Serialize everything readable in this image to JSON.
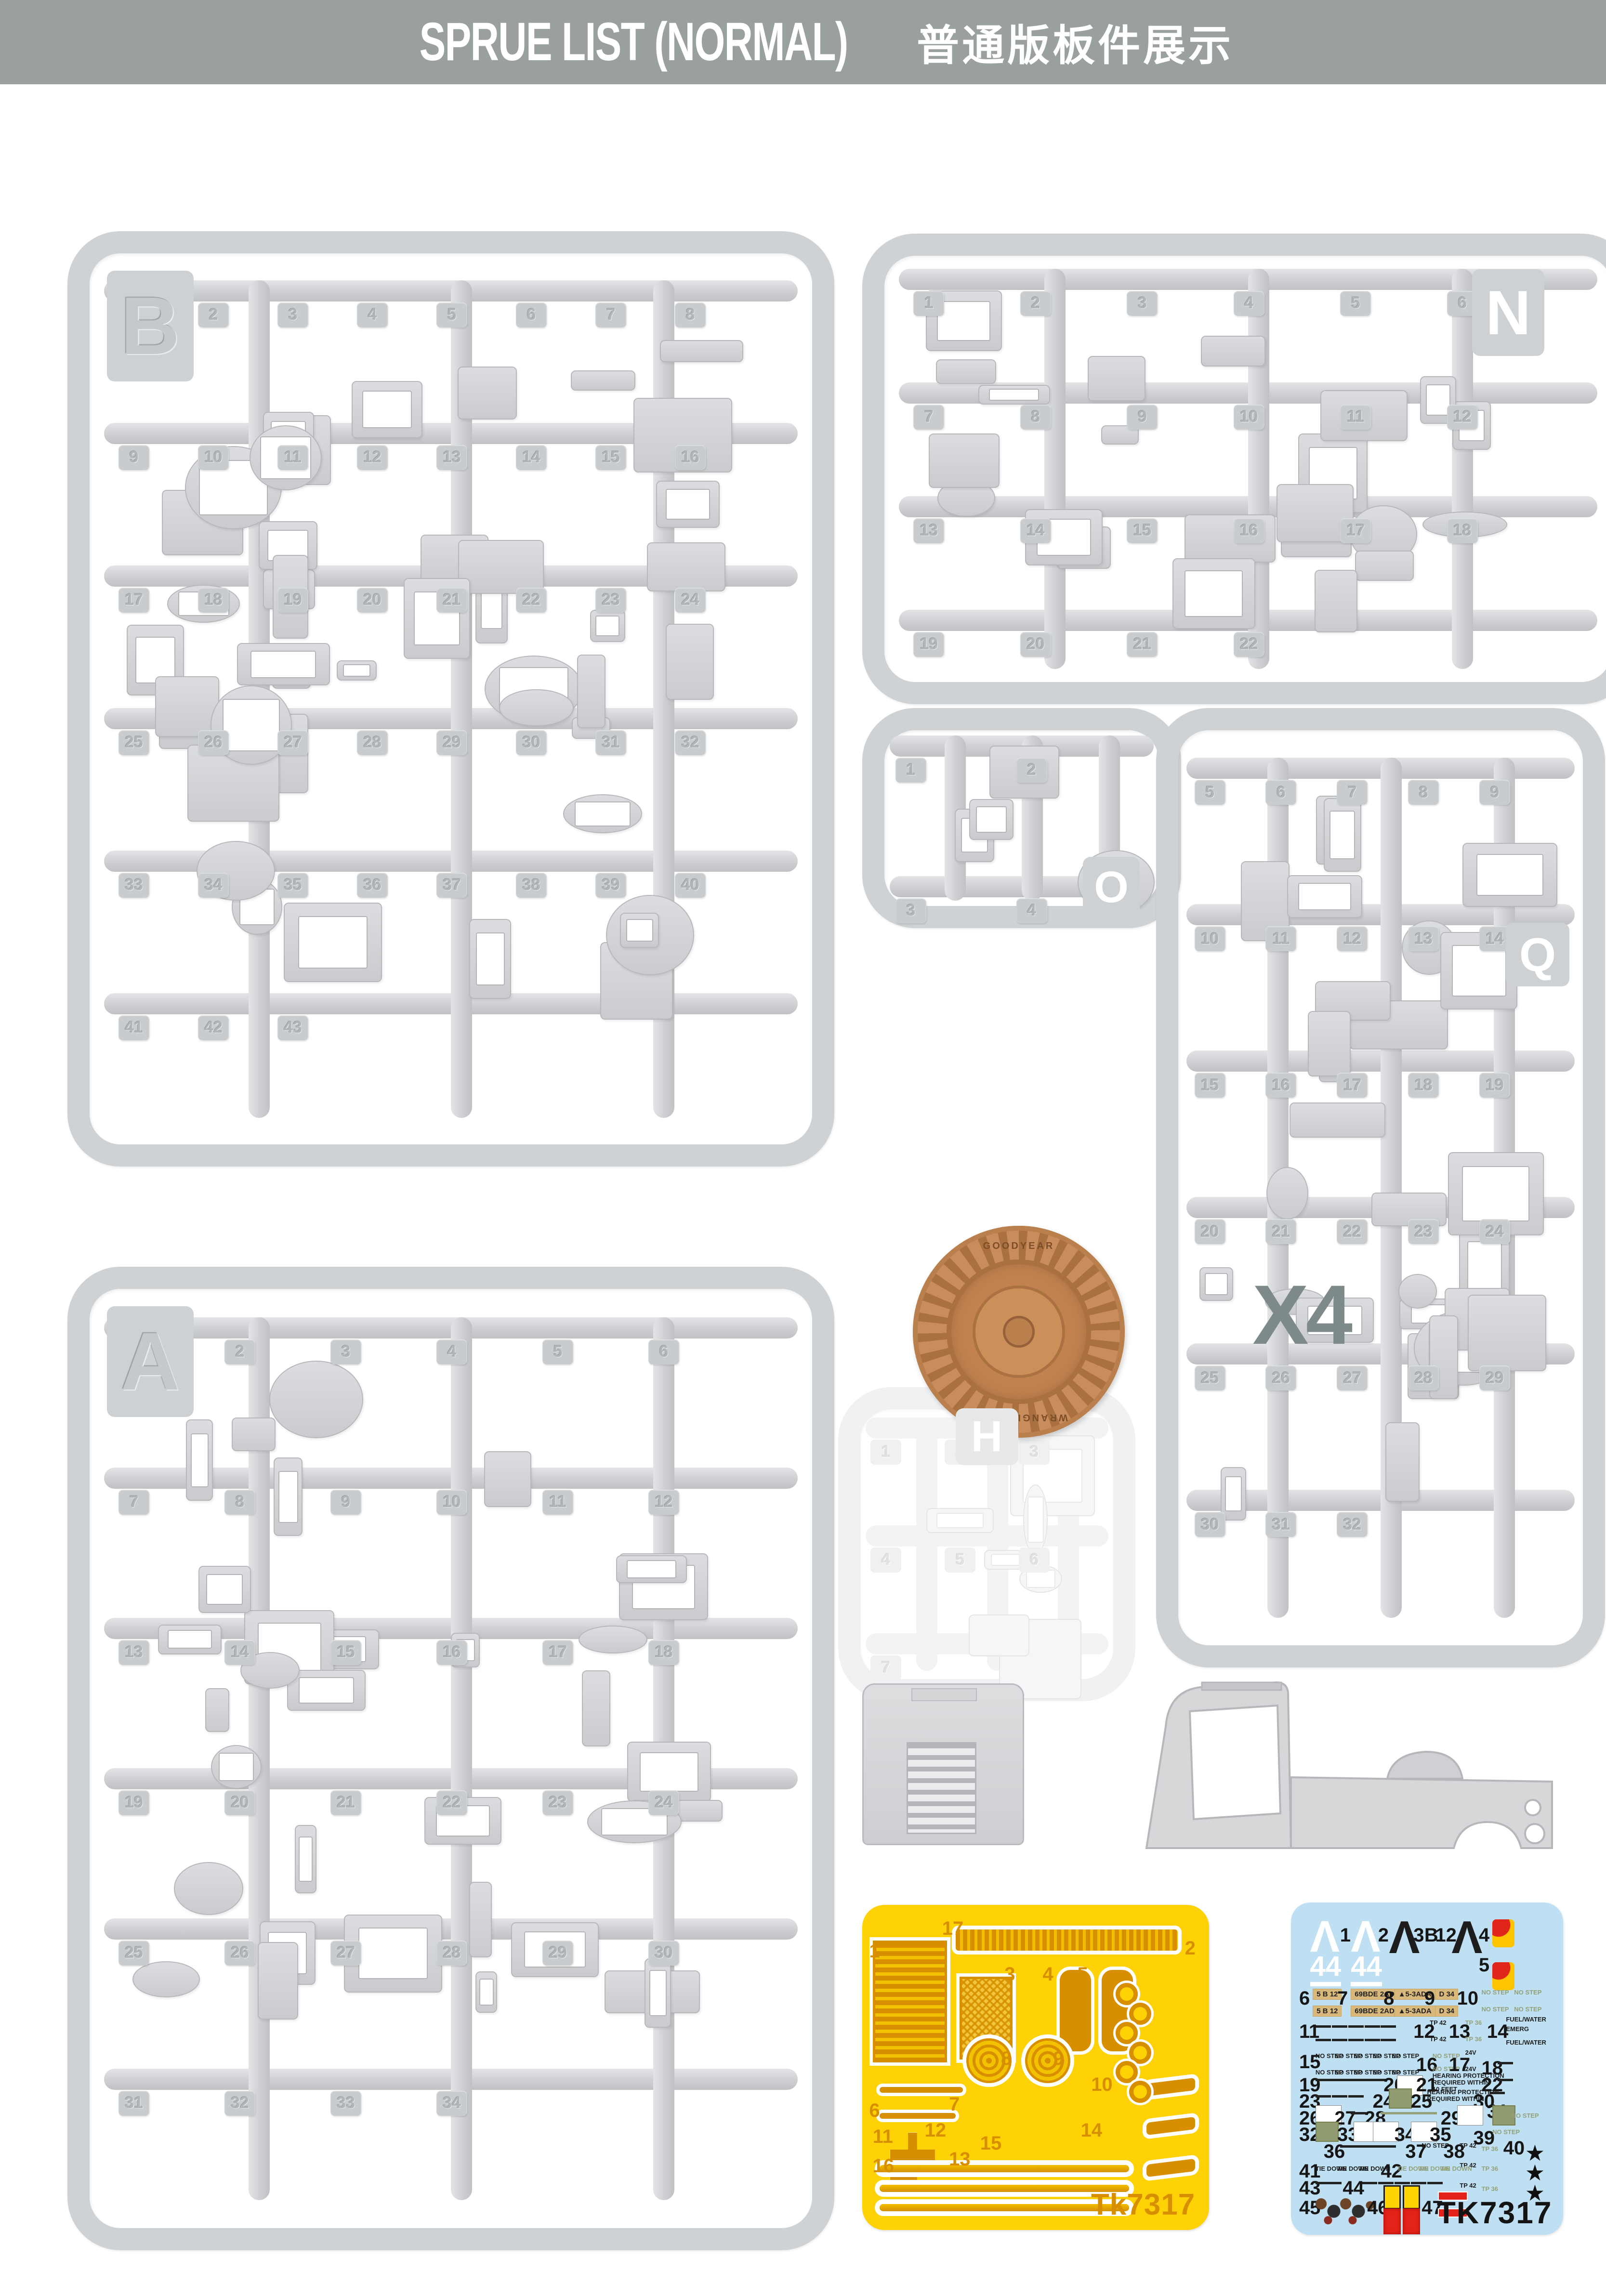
{
  "header": {
    "title_en": "SPRUE LIST (NORMAL)",
    "title_zh": "普通版板件展示"
  },
  "colors": {
    "header_bg": "#9aa0a0",
    "header_text": "#ffffff",
    "plastic": "#d2d4d6",
    "clear_plastic": "#f2f3f4",
    "tire": "#c98c5c",
    "quantity_text": "#7e898a",
    "pe_bg": "#ffd205",
    "pe_part": "#d78f00",
    "decal_bg": "#bfe0f2"
  },
  "sprues": {
    "b": {
      "letter": "B",
      "parts": [
        1,
        2,
        3,
        4,
        5,
        6,
        7,
        8,
        9,
        10,
        11,
        12,
        13,
        14,
        15,
        16,
        17,
        18,
        19,
        20,
        21,
        22,
        23,
        24,
        25,
        26,
        27,
        28,
        29,
        30,
        31,
        32,
        33,
        34,
        35,
        36,
        37,
        38,
        39,
        40,
        41,
        42,
        43
      ]
    },
    "n": {
      "letter": "N",
      "parts": [
        1,
        2,
        3,
        4,
        5,
        6,
        7,
        8,
        9,
        10,
        11,
        12,
        13,
        14,
        15,
        16,
        17,
        18,
        19,
        20,
        21,
        22
      ]
    },
    "o": {
      "letter": "O",
      "parts": [
        1,
        2,
        3,
        4
      ]
    },
    "q": {
      "letter": "Q",
      "parts": [
        5,
        6,
        7,
        8,
        9,
        10,
        11,
        12,
        13,
        14,
        15,
        16,
        17,
        18,
        19,
        20,
        21,
        22,
        23,
        24,
        25,
        26,
        27,
        28,
        29,
        30,
        31,
        32
      ]
    },
    "a": {
      "letter": "A",
      "parts": [
        1,
        2,
        3,
        4,
        5,
        6,
        7,
        8,
        9,
        10,
        11,
        12,
        13,
        14,
        15,
        16,
        17,
        18,
        19,
        20,
        21,
        22,
        23,
        24,
        25,
        26,
        27,
        28,
        29,
        30,
        31,
        32,
        33,
        34
      ]
    },
    "h": {
      "letter": "H",
      "parts": [
        1,
        2,
        3,
        4,
        5,
        6,
        7
      ]
    }
  },
  "wheel": {
    "quantity_label": "X4",
    "tire_brand": "GOODYEAR",
    "tire_model": "WRANGLER R/T"
  },
  "pe_fret": {
    "code": "Tk7317",
    "items": [
      {
        "k": "pnum",
        "x": 2,
        "y": 11,
        "t": "1"
      },
      {
        "k": "pnum",
        "x": 23,
        "y": 4,
        "t": "17"
      },
      {
        "k": "pnum",
        "x": 93,
        "y": 10,
        "t": "2"
      },
      {
        "k": "pnum",
        "x": 41,
        "y": 18,
        "t": "3"
      },
      {
        "k": "pnum",
        "x": 52,
        "y": 18,
        "t": "4"
      },
      {
        "k": "pnum",
        "x": 62,
        "y": 18,
        "t": "5"
      },
      {
        "k": "pnum",
        "x": 2,
        "y": 60,
        "t": "6"
      },
      {
        "k": "pnum",
        "x": 25,
        "y": 58,
        "t": "7"
      },
      {
        "k": "pnum",
        "x": 40,
        "y": 44,
        "t": "8"
      },
      {
        "k": "pnum",
        "x": 55,
        "y": 44,
        "t": "9"
      },
      {
        "k": "pnum",
        "x": 66,
        "y": 52,
        "t": "10"
      },
      {
        "k": "pnum",
        "x": 3,
        "y": 68,
        "t": "11"
      },
      {
        "k": "pnum",
        "x": 18,
        "y": 66,
        "t": "12"
      },
      {
        "k": "pnum",
        "x": 25,
        "y": 75,
        "t": "13"
      },
      {
        "k": "pnum",
        "x": 63,
        "y": 66,
        "t": "14"
      },
      {
        "k": "pnum",
        "x": 34,
        "y": 70,
        "t": "15"
      },
      {
        "k": "pnum",
        "x": 3,
        "y": 77,
        "t": "16"
      },
      {
        "k": "pdot",
        "x": 73,
        "y": 24
      },
      {
        "k": "pdot",
        "x": 77,
        "y": 30
      },
      {
        "k": "pdot",
        "x": 73,
        "y": 36
      },
      {
        "k": "pdot",
        "x": 77,
        "y": 42
      },
      {
        "k": "pdot",
        "x": 73,
        "y": 48
      },
      {
        "k": "pdot",
        "x": 77,
        "y": 54
      }
    ]
  },
  "decal_sheet": {
    "code": "TK7317",
    "items": [
      {
        "k": "chw",
        "x": 7,
        "y": 5,
        "t": "Λ"
      },
      {
        "k": "n",
        "x": 18,
        "y": 7,
        "t": "1"
      },
      {
        "k": "chw",
        "x": 22,
        "y": 5,
        "t": "Λ"
      },
      {
        "k": "n44",
        "x": 7,
        "y": 15,
        "t": "44"
      },
      {
        "k": "n44",
        "x": 22,
        "y": 15,
        "t": "44"
      },
      {
        "k": "n",
        "x": 32,
        "y": 7,
        "t": "2"
      },
      {
        "k": "chb",
        "x": 36,
        "y": 5,
        "t": "Λ"
      },
      {
        "k": "n",
        "x": 45,
        "y": 7,
        "t": "3"
      },
      {
        "k": "n",
        "x": 49,
        "y": 7,
        "t": "B"
      },
      {
        "k": "n",
        "x": 53,
        "y": 7,
        "t": "12"
      },
      {
        "k": "chb",
        "x": 59,
        "y": 5,
        "t": "Λ"
      },
      {
        "k": "n",
        "x": 69,
        "y": 7,
        "t": "4"
      },
      {
        "k": "flag",
        "x": 74,
        "y": 5
      },
      {
        "k": "n",
        "x": 69,
        "y": 16,
        "t": "5"
      },
      {
        "k": "flag",
        "x": 74,
        "y": 18
      },
      {
        "k": "n",
        "x": 3,
        "y": 26,
        "t": "6"
      },
      {
        "k": "tan",
        "x": 8,
        "y": 26,
        "t": "5 B 12"
      },
      {
        "k": "n",
        "x": 17,
        "y": 26,
        "t": "7"
      },
      {
        "k": "tan",
        "x": 22,
        "y": 26,
        "t": "69BDE 2ADA"
      },
      {
        "k": "n",
        "x": 34,
        "y": 26,
        "t": "8"
      },
      {
        "k": "tan",
        "x": 38,
        "y": 26,
        "t": "▲5-3ADA"
      },
      {
        "k": "n",
        "x": 49,
        "y": 26,
        "t": "9"
      },
      {
        "k": "tan",
        "x": 53,
        "y": 26,
        "t": "D 34"
      },
      {
        "k": "n",
        "x": 61,
        "y": 26,
        "t": "10"
      },
      {
        "k": "smg",
        "x": 70,
        "y": 26,
        "t": "NO STEP"
      },
      {
        "k": "smg",
        "x": 82,
        "y": 26,
        "t": "NO STEP"
      },
      {
        "k": "tan",
        "x": 8,
        "y": 31,
        "t": "5 B 12"
      },
      {
        "k": "tan",
        "x": 22,
        "y": 31,
        "t": "69BDE 2ADA"
      },
      {
        "k": "tan",
        "x": 38,
        "y": 31,
        "t": "▲5-3ADA"
      },
      {
        "k": "tan",
        "x": 53,
        "y": 31,
        "t": "D 34"
      },
      {
        "k": "smg",
        "x": 70,
        "y": 31,
        "t": "NO STEP"
      },
      {
        "k": "smg",
        "x": 82,
        "y": 31,
        "t": "NO STEP"
      },
      {
        "k": "n",
        "x": 3,
        "y": 36,
        "t": "11"
      },
      {
        "k": "bar",
        "x": 9,
        "y": 37
      },
      {
        "k": "bar",
        "x": 15,
        "y": 37
      },
      {
        "k": "bar",
        "x": 21,
        "y": 37
      },
      {
        "k": "bar",
        "x": 27,
        "y": 37
      },
      {
        "k": "bar",
        "x": 33,
        "y": 37
      },
      {
        "k": "bar",
        "x": 9,
        "y": 41
      },
      {
        "k": "bar",
        "x": 15,
        "y": 41
      },
      {
        "k": "bar",
        "x": 21,
        "y": 41
      },
      {
        "k": "bar",
        "x": 27,
        "y": 41
      },
      {
        "k": "bar",
        "x": 33,
        "y": 41
      },
      {
        "k": "n",
        "x": 45,
        "y": 36,
        "t": "12"
      },
      {
        "k": "sm",
        "x": 51,
        "y": 35,
        "t": "TP 42"
      },
      {
        "k": "sm",
        "x": 51,
        "y": 40,
        "t": "TP 42"
      },
      {
        "k": "n",
        "x": 58,
        "y": 36,
        "t": "13"
      },
      {
        "k": "smg",
        "x": 64,
        "y": 35,
        "t": "TP 36"
      },
      {
        "k": "smg",
        "x": 64,
        "y": 40,
        "t": "TP 36"
      },
      {
        "k": "n",
        "x": 72,
        "y": 36,
        "t": "14"
      },
      {
        "k": "sm",
        "x": 79,
        "y": 34,
        "t": "FUEL/WATER"
      },
      {
        "k": "sm",
        "x": 79,
        "y": 37,
        "t": "EMERG"
      },
      {
        "k": "sm",
        "x": 79,
        "y": 41,
        "t": "FUEL/WATER"
      },
      {
        "k": "n",
        "x": 3,
        "y": 45,
        "t": "15"
      },
      {
        "k": "sm",
        "x": 9,
        "y": 45,
        "t": "NO STEP"
      },
      {
        "k": "sm",
        "x": 16,
        "y": 45,
        "t": "NO STEP"
      },
      {
        "k": "sm",
        "x": 23,
        "y": 45,
        "t": "NO STEP"
      },
      {
        "k": "sm",
        "x": 30,
        "y": 45,
        "t": "NO STEP"
      },
      {
        "k": "sm",
        "x": 37,
        "y": 45,
        "t": "NO STEP"
      },
      {
        "k": "sm",
        "x": 9,
        "y": 50,
        "t": "NO STEP"
      },
      {
        "k": "sm",
        "x": 16,
        "y": 50,
        "t": "NO STEP"
      },
      {
        "k": "sm",
        "x": 23,
        "y": 50,
        "t": "NO STEP"
      },
      {
        "k": "sm",
        "x": 30,
        "y": 50,
        "t": "NO STEP"
      },
      {
        "k": "sm",
        "x": 37,
        "y": 50,
        "t": "NO STEP"
      },
      {
        "k": "n",
        "x": 46,
        "y": 46,
        "t": "16"
      },
      {
        "k": "smg",
        "x": 52,
        "y": 45,
        "t": "NO STEP"
      },
      {
        "k": "smg",
        "x": 52,
        "y": 49,
        "t": "NO STEP"
      },
      {
        "k": "n",
        "x": 58,
        "y": 46,
        "t": "17"
      },
      {
        "k": "sm",
        "x": 64,
        "y": 44,
        "t": "24V"
      },
      {
        "k": "sm",
        "x": 64,
        "y": 49,
        "t": "24V"
      },
      {
        "k": "n",
        "x": 70,
        "y": 47,
        "t": "18"
      },
      {
        "k": "bar",
        "x": 76,
        "y": 48
      },
      {
        "k": "n",
        "x": 3,
        "y": 52,
        "t": "19"
      },
      {
        "k": "bar",
        "x": 9,
        "y": 53
      },
      {
        "k": "bar",
        "x": 14,
        "y": 53
      },
      {
        "k": "bar",
        "x": 19,
        "y": 53
      },
      {
        "k": "bar",
        "x": 24,
        "y": 53
      },
      {
        "k": "bar",
        "x": 29,
        "y": 53
      },
      {
        "k": "n",
        "x": 34,
        "y": 52,
        "t": "20"
      },
      {
        "k": "wbox",
        "x": 39,
        "y": 52
      },
      {
        "k": "n",
        "x": 46,
        "y": 52,
        "t": "21"
      },
      {
        "k": "sm",
        "x": 52,
        "y": 51,
        "t": "HEARING PROTECTION"
      },
      {
        "k": "sm",
        "x": 52,
        "y": 53,
        "t": "REQUIRED WITHIN"
      },
      {
        "k": "sm",
        "x": 52,
        "y": 55,
        "t": "10 FEET"
      },
      {
        "k": "n",
        "x": 70,
        "y": 52,
        "t": "22"
      },
      {
        "k": "bar",
        "x": 76,
        "y": 53
      },
      {
        "k": "n",
        "x": 3,
        "y": 57,
        "t": "23"
      },
      {
        "k": "bar",
        "x": 9,
        "y": 58
      },
      {
        "k": "bar",
        "x": 15,
        "y": 58
      },
      {
        "k": "bar",
        "x": 21,
        "y": 58
      },
      {
        "k": "n",
        "x": 30,
        "y": 57,
        "t": "24"
      },
      {
        "k": "gbox",
        "x": 36,
        "y": 56
      },
      {
        "k": "n",
        "x": 44,
        "y": 57,
        "t": "25"
      },
      {
        "k": "sm",
        "x": 50,
        "y": 56,
        "t": "HEARING PROTECTION"
      },
      {
        "k": "sm",
        "x": 50,
        "y": 58,
        "t": "REQUIRED WITHIN"
      },
      {
        "k": "n",
        "x": 67,
        "y": 57,
        "t": "30"
      },
      {
        "k": "bar",
        "x": 73,
        "y": 57
      },
      {
        "k": "n",
        "x": 72,
        "y": 60,
        "t": "31"
      },
      {
        "k": "n",
        "x": 3,
        "y": 62,
        "t": "26"
      },
      {
        "k": "wbox",
        "x": 9,
        "y": 61
      },
      {
        "k": "n",
        "x": 16,
        "y": 62,
        "t": "27"
      },
      {
        "k": "bar",
        "x": 22,
        "y": 63
      },
      {
        "k": "n",
        "x": 27,
        "y": 62,
        "t": "28"
      },
      {
        "k": "obar",
        "x": 33,
        "y": 63
      },
      {
        "k": "obar",
        "x": 38,
        "y": 63
      },
      {
        "k": "obar",
        "x": 43,
        "y": 63
      },
      {
        "k": "obar",
        "x": 48,
        "y": 63
      },
      {
        "k": "n",
        "x": 55,
        "y": 62,
        "t": "29"
      },
      {
        "k": "wbox",
        "x": 61,
        "y": 61
      },
      {
        "k": "gbox",
        "x": 74,
        "y": 61
      },
      {
        "k": "smg",
        "x": 81,
        "y": 63,
        "t": "NO STEP"
      },
      {
        "k": "n",
        "x": 3,
        "y": 67,
        "t": "32"
      },
      {
        "k": "gbox",
        "x": 9,
        "y": 66
      },
      {
        "k": "n",
        "x": 17,
        "y": 67,
        "t": "33"
      },
      {
        "k": "wbox",
        "x": 23,
        "y": 66
      },
      {
        "k": "wbox",
        "x": 30,
        "y": 66
      },
      {
        "k": "n",
        "x": 38,
        "y": 67,
        "t": "34"
      },
      {
        "k": "wbox",
        "x": 44,
        "y": 66
      },
      {
        "k": "n",
        "x": 51,
        "y": 67,
        "t": "35"
      },
      {
        "k": "n",
        "x": 67,
        "y": 68,
        "t": "39"
      },
      {
        "k": "smg",
        "x": 74,
        "y": 68,
        "t": "NO STEP"
      },
      {
        "k": "n",
        "x": 12,
        "y": 72,
        "t": "36"
      },
      {
        "k": "bar",
        "x": 18,
        "y": 73
      },
      {
        "k": "bar",
        "x": 23,
        "y": 73
      },
      {
        "k": "bar",
        "x": 28,
        "y": 73
      },
      {
        "k": "bar",
        "x": 33,
        "y": 73
      },
      {
        "k": "n",
        "x": 42,
        "y": 72,
        "t": "37"
      },
      {
        "k": "sm",
        "x": 48,
        "y": 72,
        "t": "NO STEP"
      },
      {
        "k": "n",
        "x": 56,
        "y": 72,
        "t": "38"
      },
      {
        "k": "sm",
        "x": 62,
        "y": 72,
        "t": "TP 42"
      },
      {
        "k": "smg",
        "x": 70,
        "y": 73,
        "t": "TP 36"
      },
      {
        "k": "n",
        "x": 78,
        "y": 71,
        "t": "40"
      },
      {
        "k": "star",
        "x": 86,
        "y": 72,
        "t": "★"
      },
      {
        "k": "sm",
        "x": 62,
        "y": 78,
        "t": "TP 42"
      },
      {
        "k": "smg",
        "x": 70,
        "y": 79,
        "t": "TP 36"
      },
      {
        "k": "star",
        "x": 86,
        "y": 78,
        "t": "★"
      },
      {
        "k": "sm",
        "x": 62,
        "y": 84,
        "t": "TP 42"
      },
      {
        "k": "smg",
        "x": 70,
        "y": 85,
        "t": "TP 36"
      },
      {
        "k": "star",
        "x": 86,
        "y": 84,
        "t": "★"
      },
      {
        "k": "n",
        "x": 3,
        "y": 78,
        "t": "41"
      },
      {
        "k": "sm",
        "x": 9,
        "y": 79,
        "t": "TIE DOWN"
      },
      {
        "k": "sm",
        "x": 17,
        "y": 79,
        "t": "TIE DOWN"
      },
      {
        "k": "sm",
        "x": 25,
        "y": 79,
        "t": "TIE DOWN"
      },
      {
        "k": "n",
        "x": 33,
        "y": 78,
        "t": "42"
      },
      {
        "k": "smg",
        "x": 39,
        "y": 79,
        "t": "TIE DOWN"
      },
      {
        "k": "smg",
        "x": 47,
        "y": 79,
        "t": "TIE DOWN"
      },
      {
        "k": "smg",
        "x": 55,
        "y": 79,
        "t": "TIE DOWN"
      },
      {
        "k": "n",
        "x": 3,
        "y": 83,
        "t": "43"
      },
      {
        "k": "bar",
        "x": 9,
        "y": 84
      },
      {
        "k": "bar",
        "x": 13,
        "y": 84
      },
      {
        "k": "n",
        "x": 19,
        "y": 83,
        "t": "44"
      },
      {
        "k": "bar",
        "x": 26,
        "y": 84
      },
      {
        "k": "bar",
        "x": 32,
        "y": 84
      },
      {
        "k": "bar",
        "x": 38,
        "y": 84
      },
      {
        "k": "bar",
        "x": 44,
        "y": 84
      },
      {
        "k": "bar",
        "x": 50,
        "y": 84
      },
      {
        "k": "n",
        "x": 3,
        "y": 89,
        "t": "45"
      },
      {
        "k": "dcl",
        "x": 8,
        "y": 88
      },
      {
        "k": "dcl",
        "x": 17,
        "y": 88
      },
      {
        "k": "n",
        "x": 28,
        "y": 89,
        "t": "46"
      },
      {
        "k": "ybox",
        "x": 34,
        "y": 85
      },
      {
        "k": "ybox",
        "x": 41,
        "y": 85
      },
      {
        "k": "rbox",
        "x": 34,
        "y": 92
      },
      {
        "k": "rbox",
        "x": 41,
        "y": 92
      },
      {
        "k": "n",
        "x": 48,
        "y": 89,
        "t": "47"
      },
      {
        "k": "rstrip",
        "x": 54,
        "y": 87
      },
      {
        "k": "rstrip",
        "x": 54,
        "y": 92
      }
    ]
  }
}
